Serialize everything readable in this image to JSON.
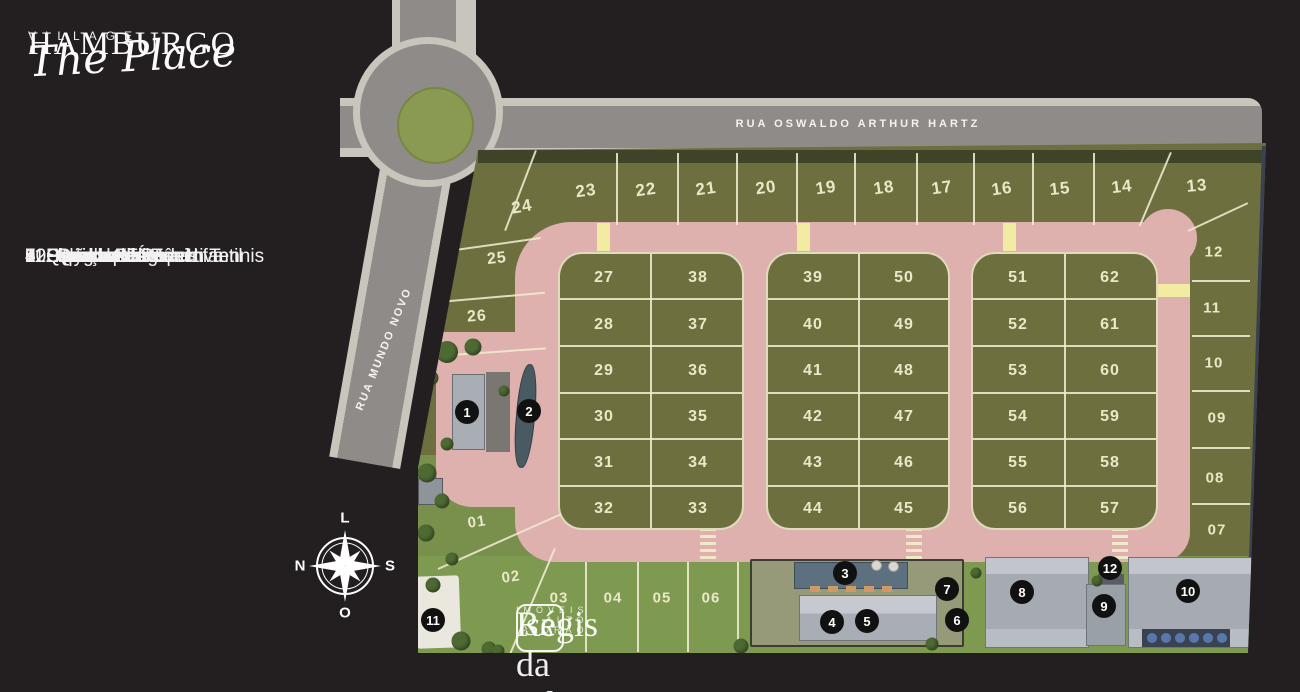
{
  "brand": {
    "name": "HAMBURGO",
    "sub": "VILLAGE",
    "script": "The Place"
  },
  "legend": {
    "items": [
      "1. Portaria",
      "2. Espelho d’Água",
      "3. Piscina Adulto e Infantil",
      "4. Fitness Center",
      "5. Salão de Festas",
      "6. Espaço Kids",
      "7. Playground",
      "8. Quadra Poliesportiva",
      "9. Quadra de Padel",
      "10. Quadra de Tênis",
      "11. Quadra de Beach Tennis",
      "12. Quiosque"
    ]
  },
  "compass": {
    "top": "L",
    "left": "N",
    "right": "S",
    "bottom": "O"
  },
  "streets": {
    "main": "RUA OSWALDO ARTHUR HARTZ",
    "side": "RUA MUNDO NOVO"
  },
  "lots": {
    "top": [
      "24",
      "23",
      "22",
      "21",
      "20",
      "19",
      "18",
      "17",
      "16",
      "15",
      "14",
      "13"
    ],
    "right": [
      "12",
      "11",
      "10",
      "09",
      "08",
      "07"
    ],
    "left": [
      "25",
      "26"
    ],
    "south": [
      "01",
      "02",
      "03",
      "04",
      "05",
      "06"
    ]
  },
  "blocks": [
    {
      "rows": [
        [
          "27",
          "38"
        ],
        [
          "28",
          "37"
        ],
        [
          "29",
          "36"
        ],
        [
          "30",
          "35"
        ],
        [
          "31",
          "34"
        ],
        [
          "32",
          "33"
        ]
      ]
    },
    {
      "rows": [
        [
          "39",
          "50"
        ],
        [
          "40",
          "49"
        ],
        [
          "41",
          "48"
        ],
        [
          "42",
          "47"
        ],
        [
          "43",
          "46"
        ],
        [
          "44",
          "45"
        ]
      ]
    },
    {
      "rows": [
        [
          "51",
          "62"
        ],
        [
          "52",
          "61"
        ],
        [
          "53",
          "60"
        ],
        [
          "54",
          "59"
        ],
        [
          "55",
          "58"
        ],
        [
          "56",
          "57"
        ]
      ]
    }
  ],
  "markers": [
    "1",
    "2",
    "3",
    "4",
    "5",
    "6",
    "7",
    "8",
    "9",
    "10",
    "11",
    "12"
  ],
  "watermark": {
    "emblem": "SR",
    "name": "Régis da Silveira",
    "tagline": "IMÓVEIS ALTO PADRÃO"
  },
  "colors": {
    "background": "#231f20",
    "road_gray": "#8f8b88",
    "sidewalk": "#c9c4bc",
    "lot_green": "#6d703e",
    "lawn_green": "#7e9a50",
    "internal_road_pink": "#deb1ae",
    "line_cream": "#ece7c9",
    "marker_black": "#111111",
    "crosswalk_yellow": "#f2eca2"
  }
}
